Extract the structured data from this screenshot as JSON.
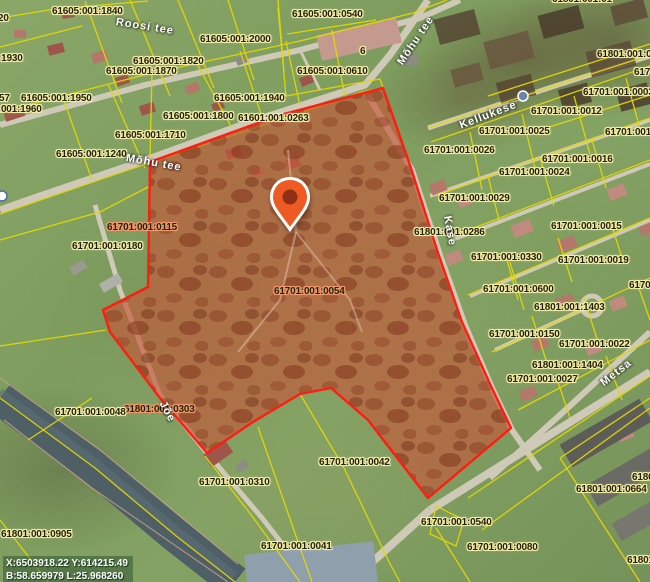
{
  "map": {
    "coordinates": {
      "line1": "X:6503918.22 Y:614215.49",
      "line2": "B:58.659979 L:25.968260"
    },
    "colors": {
      "selection_fill": "#c4583a",
      "selection_stroke": "#ff1d10",
      "cadastral_line": "#e3d800",
      "label_halo": "#f2edaa",
      "selected_label_halo": "#f09a6d",
      "marker": "#ee5a24"
    },
    "icons": {
      "marker": "location-pin",
      "stop": "bus-stop"
    },
    "labels": [
      {
        "t": "61605:001:1840",
        "x": 52,
        "y": 6
      },
      {
        "t": "20",
        "x": -2,
        "y": 13
      },
      {
        "t": "61605:001:0540",
        "x": 292,
        "y": 9
      },
      {
        "t": "61605:001:2000",
        "x": 200,
        "y": 34
      },
      {
        "t": "61605:001:1930",
        "x": -48,
        "y": 53
      },
      {
        "t": "61605:001:1820",
        "x": 133,
        "y": 56
      },
      {
        "t": "61605:001:1870",
        "x": 106,
        "y": 66
      },
      {
        "t": "61605:001:0610",
        "x": 297,
        "y": 66
      },
      {
        "t": "6",
        "x": 360,
        "y": 46
      },
      {
        "t": "57",
        "x": -1,
        "y": 93
      },
      {
        "t": "61605:001:1950",
        "x": 21,
        "y": 93
      },
      {
        "t": "61605:001:1960",
        "x": -29,
        "y": 104
      },
      {
        "t": "61605:001:1940",
        "x": 214,
        "y": 93
      },
      {
        "t": "61605:001:1800",
        "x": 163,
        "y": 111
      },
      {
        "t": "61601:001:0263",
        "x": 238,
        "y": 113
      },
      {
        "t": "61605:001:1710",
        "x": 115,
        "y": 130
      },
      {
        "t": "61605:001:1240",
        "x": 56,
        "y": 149
      },
      {
        "t": "61801:001:01",
        "x": 552,
        "y": -6
      },
      {
        "t": "61801:001:01",
        "x": 597,
        "y": 49
      },
      {
        "t": "61701:001:",
        "x": 634,
        "y": 67
      },
      {
        "t": "61701:001:0003",
        "x": 583,
        "y": 87
      },
      {
        "t": "61701:001:0012",
        "x": 531,
        "y": 106
      },
      {
        "t": "61701:001:0025",
        "x": 479,
        "y": 126
      },
      {
        "t": "61701:001:0026",
        "x": 424,
        "y": 145
      },
      {
        "t": "61701:001:0016",
        "x": 542,
        "y": 154
      },
      {
        "t": "61701:001:0024",
        "x": 499,
        "y": 167
      },
      {
        "t": "61701:001:0029",
        "x": 439,
        "y": 193
      },
      {
        "t": "61801:001:0286",
        "x": 414,
        "y": 227
      },
      {
        "t": "61701:001:0015",
        "x": 551,
        "y": 221
      },
      {
        "t": "61701:001:0330",
        "x": 471,
        "y": 252
      },
      {
        "t": "61701:001:0019",
        "x": 558,
        "y": 255
      },
      {
        "t": "61701:001:0",
        "x": 605,
        "y": 127
      },
      {
        "t": "61701:001:0600",
        "x": 483,
        "y": 284
      },
      {
        "t": "61701:",
        "x": 629,
        "y": 280
      },
      {
        "t": "61801:001:1403",
        "x": 534,
        "y": 302
      },
      {
        "t": "61701:001:0150",
        "x": 489,
        "y": 329
      },
      {
        "t": "61701:001:0022",
        "x": 559,
        "y": 339
      },
      {
        "t": "61801:001:1404",
        "x": 532,
        "y": 360
      },
      {
        "t": "61701:001:0027",
        "x": 507,
        "y": 374
      },
      {
        "t": "61701:001:0180",
        "x": 72,
        "y": 241
      },
      {
        "t": "61701:001:0115",
        "x": 107,
        "y": 222,
        "s": 1
      },
      {
        "t": "61701:001:0054",
        "x": 274,
        "y": 286,
        "s": 1
      },
      {
        "t": "61801:001:0303",
        "x": 124,
        "y": 404,
        "s": 1
      },
      {
        "t": "61701:001:0048",
        "x": 55,
        "y": 407
      },
      {
        "t": "61801:001:0905",
        "x": 1,
        "y": 529
      },
      {
        "t": "61701:001:0310",
        "x": 199,
        "y": 477
      },
      {
        "t": "61701:001:0042",
        "x": 319,
        "y": 457
      },
      {
        "t": "61701:001:0041",
        "x": 261,
        "y": 541
      },
      {
        "t": "61701:001:0540",
        "x": 421,
        "y": 517
      },
      {
        "t": "61701:001:0080",
        "x": 467,
        "y": 542
      },
      {
        "t": "61801:001:0664",
        "x": 576,
        "y": 484
      },
      {
        "t": "61801",
        "x": 632,
        "y": 472
      },
      {
        "t": "61801:0",
        "x": 627,
        "y": 555
      }
    ],
    "streets": [
      {
        "t": "Roosi tee",
        "x": 116,
        "y": 16,
        "r": 9
      },
      {
        "t": "Mõhu tee",
        "x": 400,
        "y": 58,
        "r": -56
      },
      {
        "t": "Mõhu tee",
        "x": 126,
        "y": 152,
        "r": 10
      },
      {
        "t": "Kellukese",
        "x": 460,
        "y": 120,
        "r": -21
      },
      {
        "t": "Kase",
        "x": 447,
        "y": 210,
        "r": 80
      },
      {
        "t": "Metsa",
        "x": 602,
        "y": 378,
        "r": -38
      },
      {
        "t": "Jõe",
        "x": 162,
        "y": 396,
        "r": 62
      }
    ]
  }
}
